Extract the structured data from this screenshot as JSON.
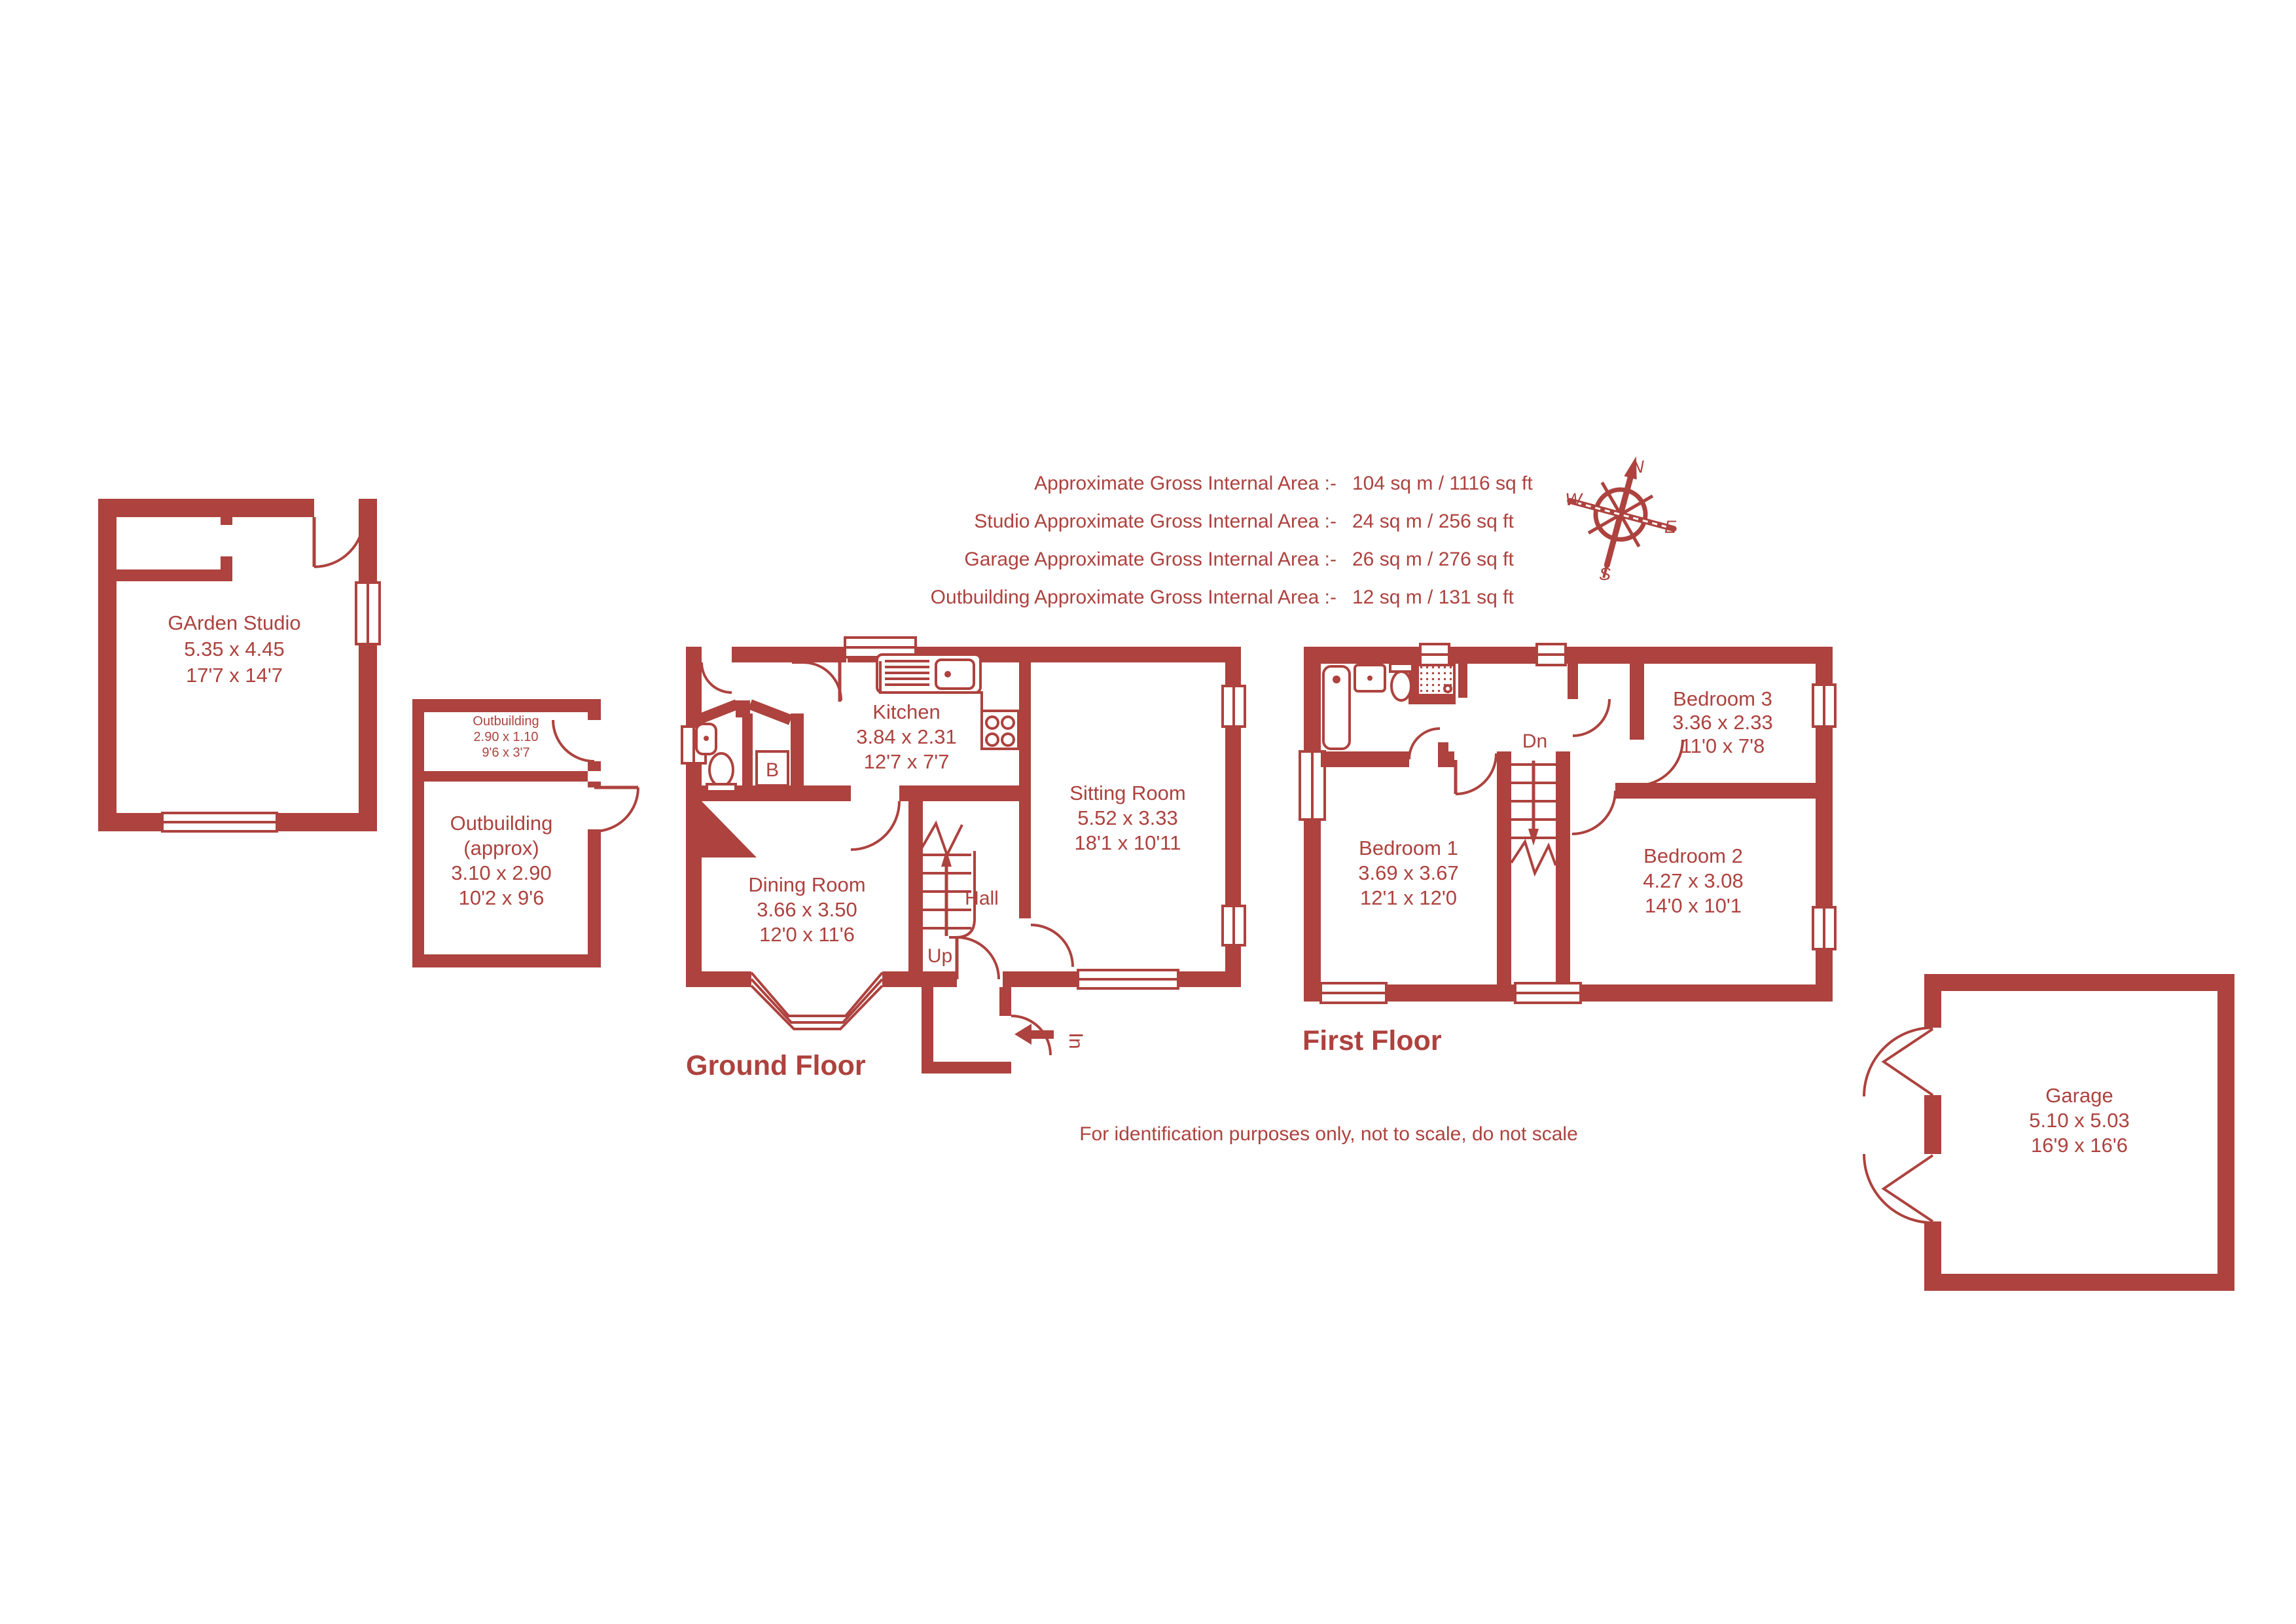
{
  "colors": {
    "accent": "#ad423e",
    "background": "#ffffff"
  },
  "area_summary": {
    "lines": [
      {
        "label": "Approximate Gross Internal Area  :-",
        "value": "104 sq m /  1116 sq ft"
      },
      {
        "label": "Studio Approximate Gross Internal Area  :-",
        "value": "24 sq m /  256 sq ft"
      },
      {
        "label": "Garage Approximate Gross Internal Area  :-",
        "value": "26 sq m /  276 sq ft"
      },
      {
        "label": "Outbuilding Approximate Gross Internal Area  :-",
        "value": "12 sq m /  131 sq ft"
      }
    ]
  },
  "compass": {
    "north": "N",
    "east": "E",
    "south": "S",
    "west": "W"
  },
  "rooms": {
    "garden_studio": {
      "name": "GArden Studio",
      "metric": "5.35 x 4.45",
      "imperial": "17'7 x 14'7"
    },
    "outbuilding_store": {
      "name": "Outbuilding",
      "metric": "2.90 x 1.10",
      "imperial": "9'6 x 3'7"
    },
    "outbuilding_main": {
      "name": "Outbuilding",
      "qualifier": "(approx)",
      "metric": "3.10 x 2.90",
      "imperial": "10'2 x 9'6"
    },
    "kitchen": {
      "name": "Kitchen",
      "metric": "3.84 x 2.31",
      "imperial": "12'7 x 7'7"
    },
    "sitting_room": {
      "name": "Sitting Room",
      "metric": "5.52 x 3.33",
      "imperial": "18'1 x 10'11"
    },
    "dining_room": {
      "name": "Dining Room",
      "metric": "3.66 x 3.50",
      "imperial": "12'0 x 11'6"
    },
    "hall": {
      "name": "Hall"
    },
    "bedroom1": {
      "name": "Bedroom 1",
      "metric": "3.69 x 3.67",
      "imperial": "12'1 x 12'0"
    },
    "bedroom2": {
      "name": "Bedroom 2",
      "metric": "4.27 x 3.08",
      "imperial": "14'0 x 10'1"
    },
    "bedroom3": {
      "name": "Bedroom 3",
      "metric": "3.36 x 2.33",
      "imperial": "11'0 x 7'8"
    },
    "garage": {
      "name": "Garage",
      "metric": "5.10 x 5.03",
      "imperial": "16'9 x 16'6"
    }
  },
  "labels": {
    "ground_floor": "Ground Floor",
    "first_floor": "First Floor",
    "up": "Up",
    "down": "Dn",
    "in": "In",
    "boiler": "B"
  },
  "disclaimer": "For identification purposes only, not to scale, do not scale"
}
